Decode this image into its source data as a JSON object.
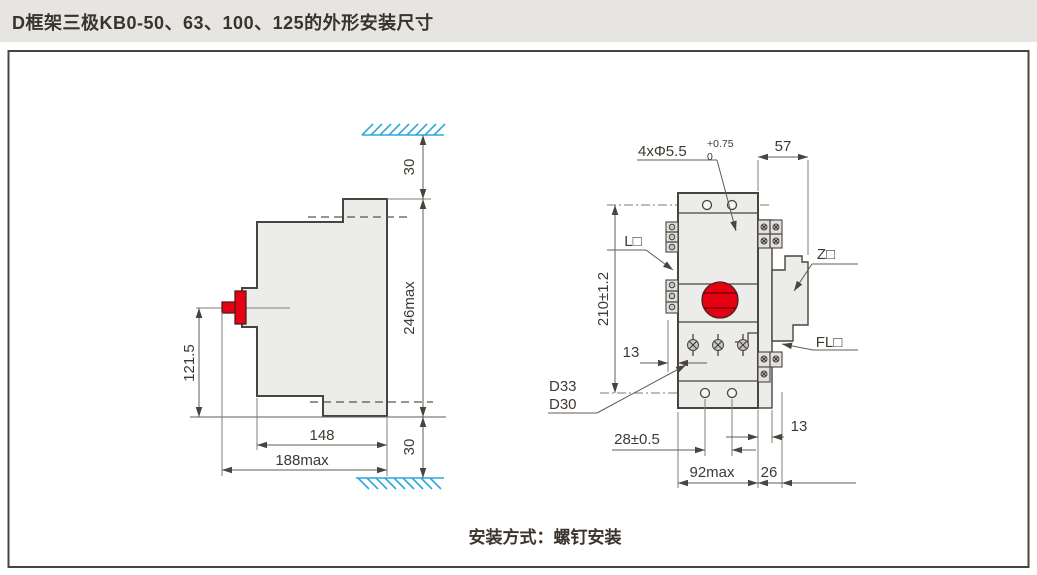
{
  "header": {
    "title": "D框架三极KB0-50、63、100、125的外形安装尺寸"
  },
  "footer": {
    "caption": "安装方式：螺钉安装"
  },
  "side_view": {
    "dim_top_clearance": "30",
    "dim_bottom_clearance": "30",
    "dim_height_max": "246max",
    "dim_handle_height": "121.5",
    "dim_depth": "148",
    "dim_depth_max": "188max"
  },
  "front_view": {
    "dim_mount_holes": "4xΦ5.5",
    "dim_mount_holes_tol_upper": "+0.75",
    "dim_mount_holes_tol_lower": "0",
    "dim_side_attach_depth": "57",
    "dim_hole_pitch_vertical": "210±1.2",
    "dim_terminal_depth": "13",
    "label_model_1": "D33",
    "label_model_2": "D30",
    "dim_pole_pitch": "28±0.5",
    "dim_width_max": "92max",
    "dim_attach_width": "26",
    "dim_strip_width": "13",
    "label_l_terminal": "L□",
    "label_z_module": "Z□",
    "label_fl_module": "FL□"
  },
  "colors": {
    "accent_red": "#e60013",
    "hatch_blue": "#2fa7dc",
    "body_fill": "#ececea",
    "line_dark": "#4a443e",
    "titlebar_bg": "#e7e5e2"
  }
}
